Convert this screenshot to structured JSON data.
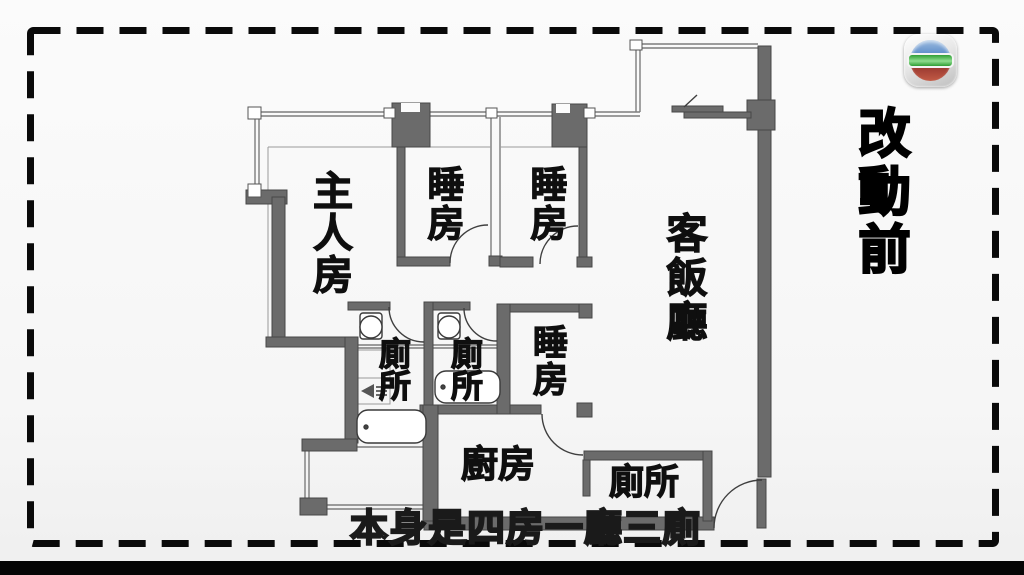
{
  "broadcast": {
    "logo_icon": "tvb-logo",
    "stage_label": "改動前",
    "caption": "本身是四房一廳三廁"
  },
  "floorplan": {
    "rooms": [
      {
        "id": "master-bedroom",
        "label": "主人房"
      },
      {
        "id": "bedroom-1",
        "label": "睡房"
      },
      {
        "id": "bedroom-2",
        "label": "睡房"
      },
      {
        "id": "living-dining",
        "label": "客飯廳"
      },
      {
        "id": "bedroom-3",
        "label": "睡房"
      },
      {
        "id": "toilet-1",
        "label": "廁所"
      },
      {
        "id": "toilet-2",
        "label": "廁所"
      },
      {
        "id": "kitchen",
        "label": "廚房"
      },
      {
        "id": "toilet-3",
        "label": "廁所"
      }
    ],
    "fixtures": [
      "toilet-bowl-icon",
      "toilet-bowl-icon",
      "bathtub-icon",
      "bathtub-icon",
      "shower-icon"
    ],
    "colors": {
      "wall": "#6b6b6b",
      "wall_edge": "#474747",
      "thin_line": "#7d7d7d",
      "dash_border": "#0a0a0a",
      "caption_fill": "#ffffff",
      "caption_outline": "#1a1a1a",
      "logo_blue": "#4a7ec2",
      "logo_green": "#2f9e35",
      "logo_red": "#8d2f2a"
    }
  }
}
